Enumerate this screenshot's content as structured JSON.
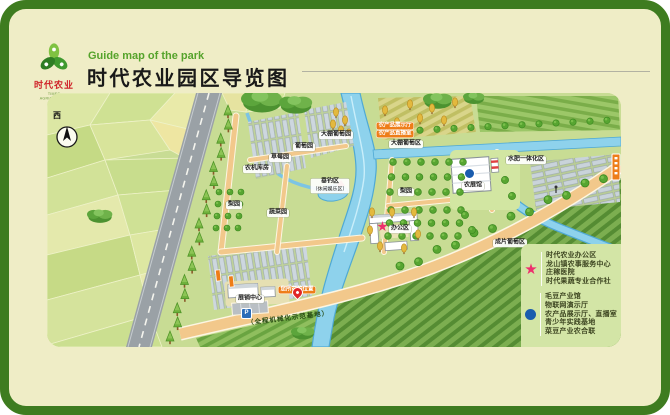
{
  "header": {
    "subtitle_en": "Guide map of the park",
    "title": "时代农业园区导览图",
    "logo_text": "时代农业",
    "logo_subtext": "TIMES AGRICULTURE"
  },
  "map": {
    "compass_label": "西",
    "parking_label": "P",
    "road_banner": "（全程机械化示范基地）",
    "labels": [
      {
        "text": "农机库房",
        "x": 257,
        "y": 169,
        "kind": "white"
      },
      {
        "text": "草莓园",
        "x": 280,
        "y": 158,
        "kind": "white"
      },
      {
        "text": "葡萄园",
        "x": 304,
        "y": 147,
        "kind": "white"
      },
      {
        "text": "大棚葡萄园",
        "x": 336,
        "y": 135,
        "kind": "white"
      },
      {
        "text": "大棚葡萄区",
        "x": 406,
        "y": 144,
        "kind": "white"
      },
      {
        "text": "梨园",
        "x": 234,
        "y": 205,
        "kind": "white"
      },
      {
        "text": "蔬菜园",
        "x": 278,
        "y": 213,
        "kind": "white"
      },
      {
        "text": "垂钓区",
        "sub": "（休闲娱乐区）",
        "x": 330,
        "y": 186,
        "kind": "white"
      },
      {
        "text": "展销中心",
        "x": 250,
        "y": 299,
        "kind": "white"
      },
      {
        "text": "梨园",
        "x": 406,
        "y": 192,
        "kind": "white"
      },
      {
        "text": "农展馆",
        "x": 473,
        "y": 186,
        "kind": "white"
      },
      {
        "text": "办公区",
        "x": 400,
        "y": 229,
        "kind": "white"
      },
      {
        "text": "水肥一体化区",
        "x": 526,
        "y": 160,
        "kind": "white"
      },
      {
        "text": "成片葡萄区",
        "x": 510,
        "y": 243,
        "kind": "white"
      },
      {
        "text": "农产品展示厅",
        "x": 395,
        "y": 126,
        "kind": "orange"
      },
      {
        "text": "农产品直播室",
        "x": 395,
        "y": 134,
        "kind": "orange"
      },
      {
        "text": "您所在的位置",
        "x": 297,
        "y": 290,
        "kind": "orange"
      }
    ]
  },
  "legend": {
    "groups": [
      {
        "marker": "star",
        "color": "#ed2f6d",
        "items": [
          "时代农业办公区",
          "龙山镇农事服务中心",
          "庄稼医院",
          "时代果蔬专业合作社"
        ]
      },
      {
        "marker": "circle",
        "color": "#1a5cae",
        "items": [
          "毛豆产业馆",
          "物联网演示厅",
          "农产品展示厅、直播室",
          "青少年实践基地",
          "菜豆产业农合联"
        ]
      }
    ]
  }
}
